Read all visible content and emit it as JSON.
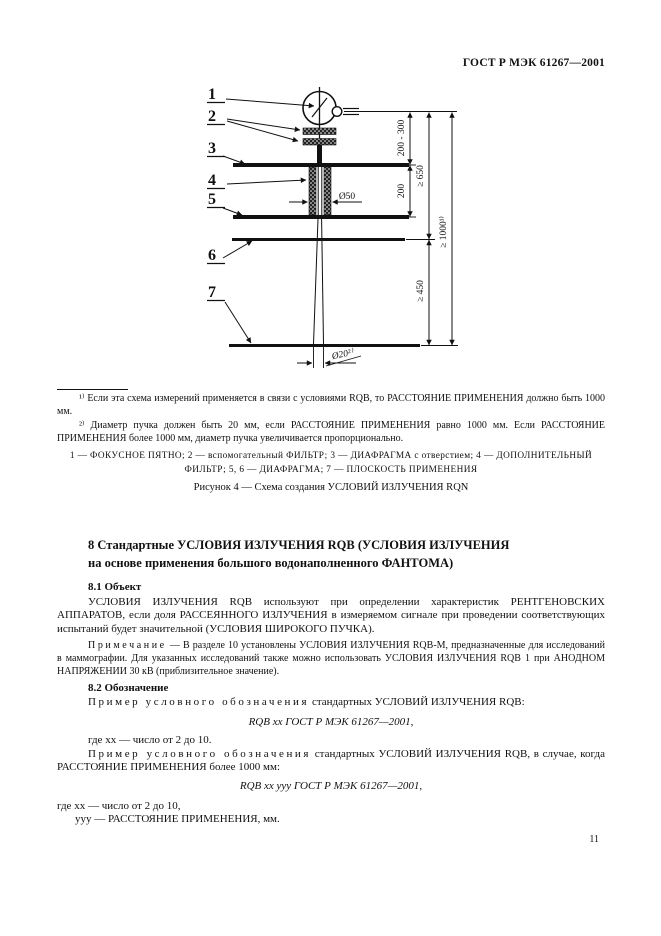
{
  "page": {
    "header": "ГОСТ Р МЭК 61267—2001",
    "number": "11"
  },
  "figure": {
    "callouts": [
      "1",
      "2",
      "3",
      "4",
      "5",
      "6",
      "7"
    ],
    "dims": {
      "d200_300": "200 - 300",
      "d200": "200",
      "d650": "≥ 650",
      "d450": "≥ 450",
      "d1000": "≥ 1000¹⁾",
      "d50": "Ø50",
      "d20": "Ø20²⁾"
    },
    "footnote1": "¹⁾ Если эта схема измерений применяется в связи с условиями RQB, то РАССТОЯНИЕ ПРИМЕНЕНИЯ должно быть 1000 мм.",
    "footnote2": "²⁾ Диаметр пучка должен быть 20 мм, если РАССТОЯНИЕ ПРИМЕНЕНИЯ равно 1000 мм. Если РАССТОЯНИЕ ПРИМЕНЕНИЯ более 1000 мм, диаметр пучка увеличивается пропорционально.",
    "legend": "1 — ФОКУСНОЕ ПЯТНО; 2 — вспомогательный ФИЛЬТР; 3 — ДИАФРАГМА с отверстием; 4 — ДОПОЛНИТЕЛЬНЫЙ\nФИЛЬТР; 5, 6 — ДИАФРАГМА; 7 — ПЛОСКОСТЬ ПРИМЕНЕНИЯ",
    "caption": "Рисунок 4 — Схема создания УСЛОВИЙ ИЗЛУЧЕНИЯ RQN"
  },
  "section8": {
    "heading": "8  Стандартные УСЛОВИЯ ИЗЛУЧЕНИЯ RQB (УСЛОВИЯ ИЗЛУЧЕНИЯ\nна основе применения большого водонаполненного ФАНТОМА)",
    "s81_title": "8.1  Объект",
    "s81_body": "УСЛОВИЯ ИЗЛУЧЕНИЯ RQB используют при определении характеристик РЕНТГЕНОВ­СКИХ АППАРАТОВ, если доля РАССЕЯННОГО ИЗЛУЧЕНИЯ в измеряемом сигнале при прове­дении соответствующих испытаний будет значительной (УСЛОВИЯ ШИРОКОГО ПУЧКА).",
    "note_label": "Примечание",
    "note_text": " — В разделе 10 установлены УСЛОВИЯ ИЗЛУЧЕНИЯ RQB-M, предназначенные для исследований в маммографии. Для указанных исследований также можно использовать УСЛОВИЯ ИЗЛУЧЕ­НИЯ RQB 1 при АНОДНОМ НАПРЯЖЕНИИ 30 кВ (приблизительное значение).",
    "s82_title": "8.2  Обозначение",
    "example1_spaced": "Пример условного обозначения",
    "example1_rest": " стандартных УСЛОВИЙ ИЗЛУЧЕНИЯ RQB:",
    "formula1": "RQB xx ГОСТ Р МЭК 61267—2001,",
    "where1": "где xx — число от 2 до 10.",
    "example2_spaced": "Пример условного обозначения",
    "example2_rest": " стандартных УСЛОВИЙ ИЗЛУЧЕНИЯ RQB, в случае, когда РАССТОЯНИЕ ПРИМЕНЕНИЯ более 1000 мм:",
    "formula2": "RQB xx yyy ГОСТ Р МЭК 61267—2001,",
    "where2a": "где xx — число от 2 до 10,",
    "where2b": "yyy — РАССТОЯНИЕ ПРИМЕНЕНИЯ, мм."
  }
}
